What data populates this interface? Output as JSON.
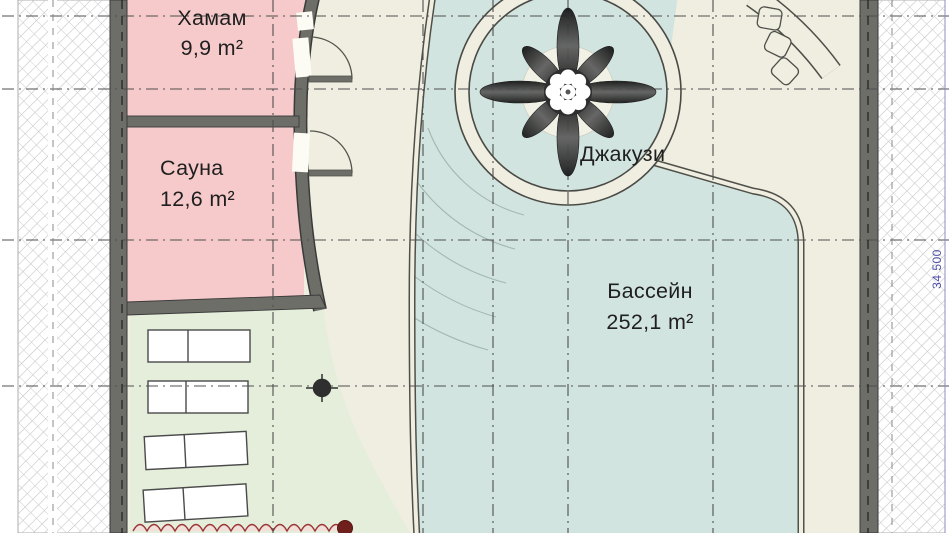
{
  "plan": {
    "rooms": {
      "hammam": {
        "name": "Хамам",
        "area": "9,9 m²"
      },
      "sauna": {
        "name": "Сауна",
        "area": "12,6 m²"
      },
      "jacuzzi": {
        "name": "Джакузи"
      },
      "pool": {
        "name": "Бассейн",
        "area": "252,1 m²"
      }
    },
    "dimensions": {
      "right_vertical": "34 500"
    },
    "colors": {
      "wall_gray": "#6e6e69",
      "room_pink": "#f6caca",
      "pool_teal": "#d2e4df",
      "deck_beige": "#efeee1",
      "floor_green": "#e4eeda",
      "trim_red": "#9b3636",
      "dimension_blue": "#4d4da8",
      "grid_gray": "#4f4f4f"
    }
  }
}
